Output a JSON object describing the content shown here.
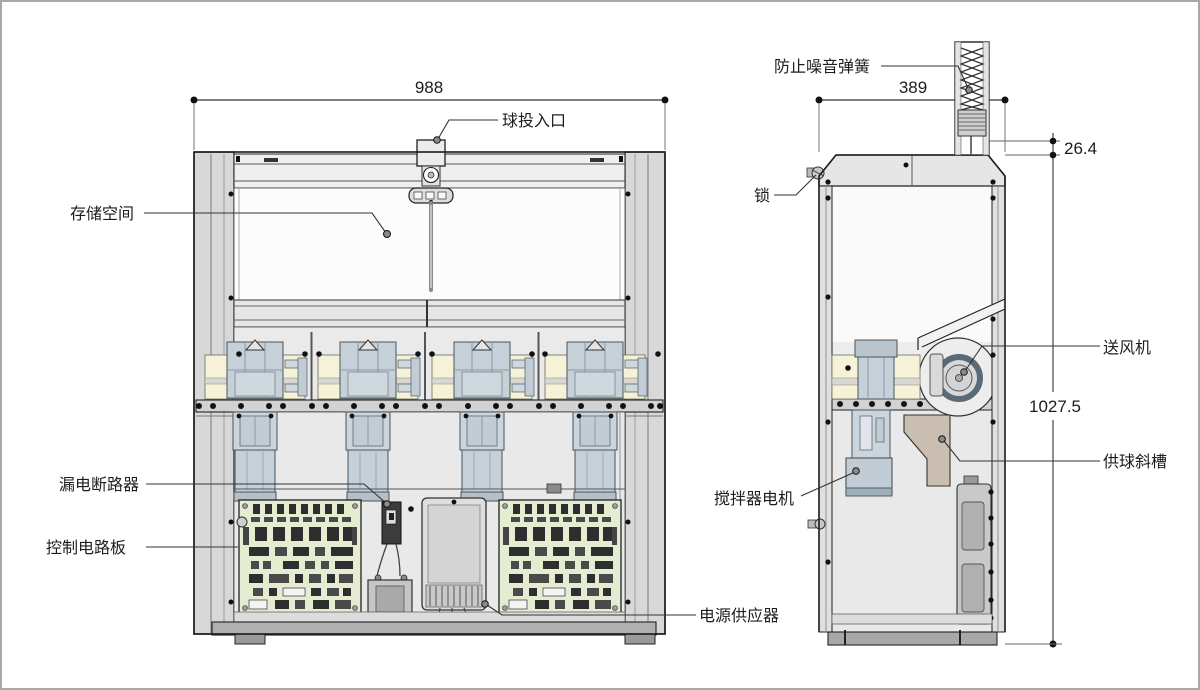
{
  "drawing": {
    "type": "two-view technical drawing of ball dispensing machine",
    "front_view": {
      "dimensions": {
        "overall_width": "988"
      },
      "labels": {
        "ball_inlet": "球投入口",
        "storage_space": "存储空间",
        "leakage_breaker": "漏电断路器",
        "control_board": "控制电路板",
        "power_supply": "电源供应器"
      }
    },
    "side_view": {
      "dimensions": {
        "overall_depth": "389",
        "spring_gap": "26.4",
        "overall_height": "1027.5"
      },
      "labels": {
        "noise_spring": "防止噪音弹簧",
        "lock": "锁",
        "blower_fan": "送风机",
        "ball_supply_chute": "供球斜槽",
        "stirrer_motor": "搅拌器电机"
      }
    },
    "colors": {
      "outline": "#1a1a1a",
      "frame_gray": "#d8d8d8",
      "panel_cream": "#f6f2d7",
      "motor_blue_gray": "#c6d0d8",
      "pcb_green": "#e4ecd2",
      "chute_tan": "#c9beb1"
    }
  }
}
